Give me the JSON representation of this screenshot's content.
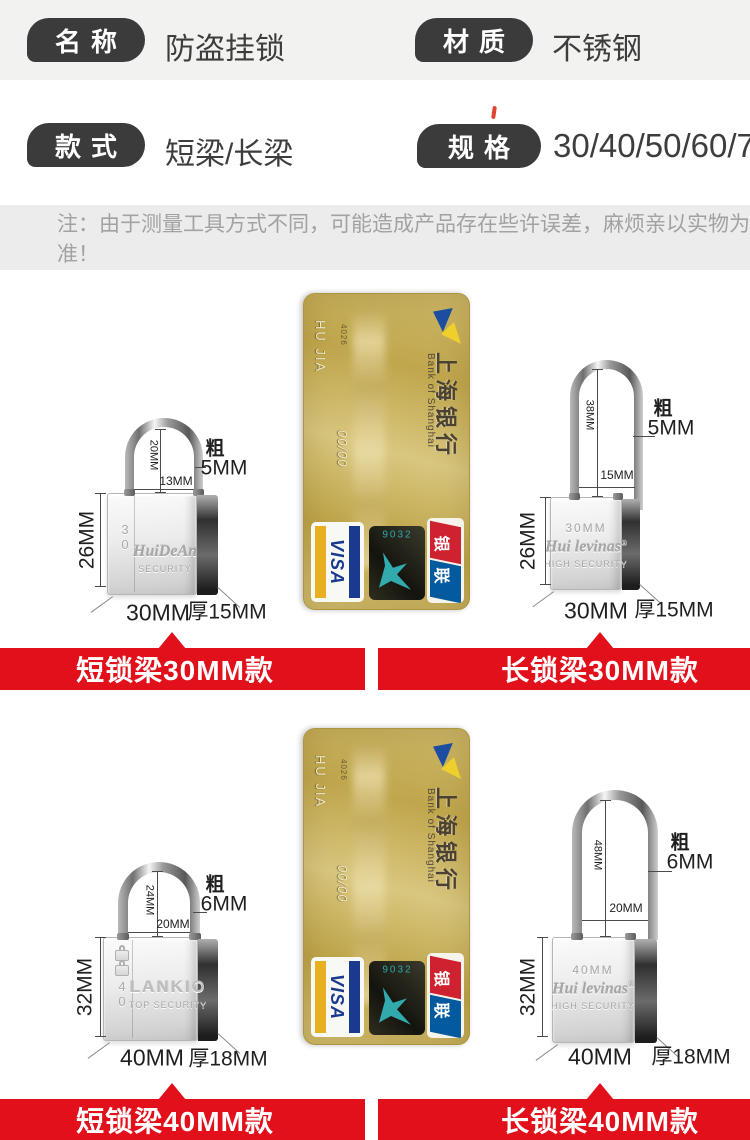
{
  "colors": {
    "banner_red": "#e1101a",
    "pill_dark": "#3b3b3b",
    "note_grey_bg": "#ececec",
    "card_gold": "#c9b35f"
  },
  "spec_rows": [
    {
      "label": "名称",
      "value": "防盗挂锁"
    },
    {
      "label": "材质",
      "value": "不锈钢"
    },
    {
      "label": "款式",
      "value": "短梁/长梁"
    },
    {
      "label": "规格",
      "value": "30/40/50/60/70"
    }
  ],
  "note": "注：由于测量工具方式不同，可能造成产品存在些许误差，麻烦亲以实物为准！",
  "figures": [
    {
      "inner_height": "20MM",
      "inner_width": "13MM",
      "gauge_label": "粗",
      "gauge": "5MM",
      "body_height": "26MM",
      "body_width": "30MM",
      "body_depth": "厚15MM",
      "engraving_brand": "HuiDeAn",
      "engraving_sub": "SECURITY",
      "engraving_side": "30"
    },
    {
      "inner_height": "38MM",
      "inner_width": "15MM",
      "gauge_label": "粗",
      "gauge": "5MM",
      "body_height": "26MM",
      "body_width": "30MM",
      "body_depth": "厚15MM",
      "engraving_top": "30MM",
      "engraving_brand": "Hui levinas",
      "engraving_reg": "®",
      "engraving_sub": "HIGH SECURITY"
    },
    {
      "inner_height": "24MM",
      "inner_width": "20MM",
      "gauge_label": "粗",
      "gauge": "6MM",
      "body_height": "32MM",
      "body_width": "40MM",
      "body_depth": "厚18MM",
      "engraving_brand": "LANKIO",
      "engraving_sub": "TOP SECURITY",
      "engraving_side": "40"
    },
    {
      "inner_height": "48MM",
      "inner_width": "20MM",
      "gauge_label": "粗",
      "gauge": "6MM",
      "body_height": "32MM",
      "body_width": "40MM",
      "body_depth": "厚18MM",
      "engraving_top": "40MM",
      "engraving_brand": "Hui levinas",
      "engraving_reg": "®",
      "engraving_sub": "HIGH SECURITY"
    }
  ],
  "banners": [
    "短锁梁30MM款",
    "长锁梁30MM款",
    "短锁梁40MM款",
    "长锁梁40MM款"
  ],
  "card": {
    "bank_name_cn": "上海银行",
    "bank_name_en": "Bank of Shanghai",
    "bin_digits": "4026",
    "expiry": "00/00",
    "holder_name": "HU JIA",
    "visa_label": "VISA",
    "unionpay_label": "银联",
    "hologram_label": "9032"
  }
}
